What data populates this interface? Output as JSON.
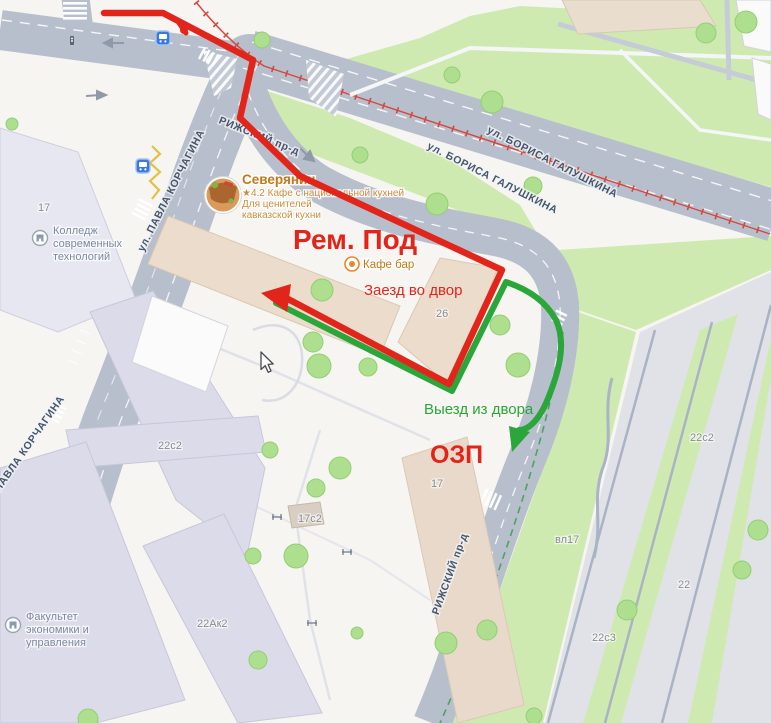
{
  "map": {
    "streets": {
      "galushkina_1": "ул. БОРИСА ГАЛУШКИНА",
      "galushkina_2": "ул. БОРИСА ГАЛУШКИНА",
      "korchagina_1": "ул. ПАВЛА КОРЧАГИНА",
      "korchagina_2": "ул. ПАВЛА КОРЧАГИНА",
      "rizhsky_1": "РИЖСКИЙ пр-д",
      "rizhsky_2": "РИЖСКИЙ пр-д"
    },
    "buildings": {
      "college_number": "17",
      "b26": "26",
      "b22c2_left": "22с2",
      "b17c2": "17с2",
      "b17_ozp": "17",
      "b22ak2": "22Ак2",
      "b22c2_right": "22с2",
      "bvl17": "вл17",
      "b22": "22",
      "b22c3": "22с3"
    },
    "pois": {
      "cafe": {
        "name": "Северянин",
        "rating_line": "★4.2 Кафе с национальной кухней",
        "tagline_1": "Для ценителей",
        "tagline_2": "кавказской кухни",
        "bar_label": "Кафе бар"
      },
      "college": {
        "line1": "Колледж",
        "line2": "современных",
        "line3": "технологий"
      },
      "faculty": {
        "line1": "Факультет",
        "line2": "экономики и",
        "line3": "управления"
      }
    }
  },
  "overlay": {
    "title": "Рем. Под",
    "entry_label": "Заезд во двор",
    "exit_label": "Выезд из двора",
    "ozp_label": "ОЗП"
  },
  "colors": {
    "overlay_red": "#e2251b",
    "overlay_green": "#2aa63a",
    "tram_red": "#d4473e",
    "poi_orange": "#c1791b",
    "street_label": "#46566b",
    "building_label": "#8b8b94",
    "road_fill": "#b8bfcc",
    "green_area": "#cfeab0"
  }
}
